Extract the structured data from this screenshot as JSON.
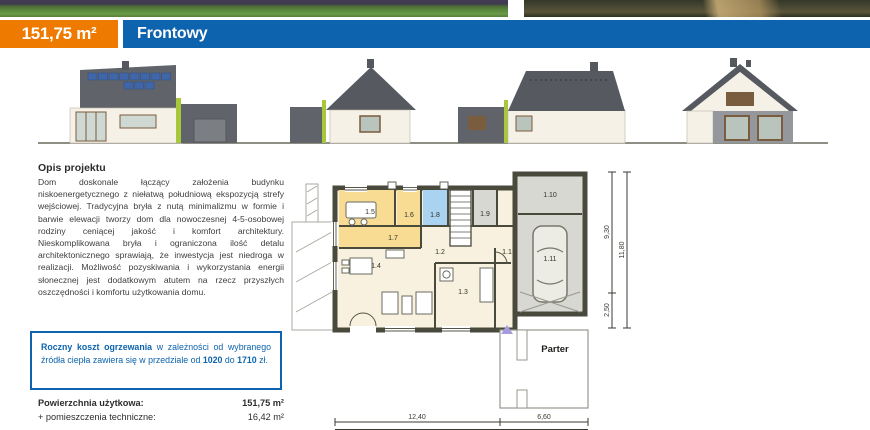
{
  "header": {
    "area_badge": "151,75 m²",
    "project_name": "Frontowy"
  },
  "colors": {
    "accent_orange": "#ee7b00",
    "accent_blue": "#0d63ad",
    "plan_wall": "#4a4a3c",
    "room_yellow": "#f8dc94",
    "room_blue": "#a9d3f0",
    "room_gray": "#d8d8d3",
    "elevation_green": "#a8c83c",
    "elevation_roof": "#565a60"
  },
  "description": {
    "heading": "Opis projektu",
    "body": "Dom doskonale łączący założenia budynku niskoenergetycznego z niełatwą południową ekspozycją strefy wejściowej. Tradycyjna bryła z nutą minimalizmu w formie i barwie elewacji tworzy dom dla nowoczesnej 4-5-osobowej rodziny ceniącej jakość i komfort architektury. Nieskomplikowana bryła i ograniczona ilość detalu architektonicznego sprawiają, że inwestycja jest niedroga w realizacji. Możliwość pozyskiwania i wykorzystania energii słonecznej jest dodatkowym atutem na rzecz przyszłych oszczędności i komfortu użytkowania domu."
  },
  "cost_box": {
    "lead_bold": "Roczny koszt ogrzewania",
    "text_mid": " w zależności od wybranego źródła ciepła zawiera się w przedziale od ",
    "value_low": "1020",
    "text_between": " do ",
    "value_high": "1710",
    "text_end": " zł."
  },
  "areas": {
    "rows": [
      {
        "label": "Powierzchnia użytkowa:",
        "value": "151,75 m²"
      },
      {
        "label": "+ pomieszczenia techniczne:",
        "value": "16,42 m²"
      }
    ]
  },
  "plan": {
    "floor_label": "Parter",
    "rooms": [
      "1.1",
      "1.2",
      "1.3",
      "1.4",
      "1.5",
      "1.6",
      "1.7",
      "1.8",
      "1.9",
      "1.10",
      "1.11"
    ],
    "dims": {
      "bottom_left": "12,40",
      "bottom_right": "6,60",
      "right_upper": "9,30",
      "right_lower": "2,50",
      "right_total": "11,80"
    }
  }
}
